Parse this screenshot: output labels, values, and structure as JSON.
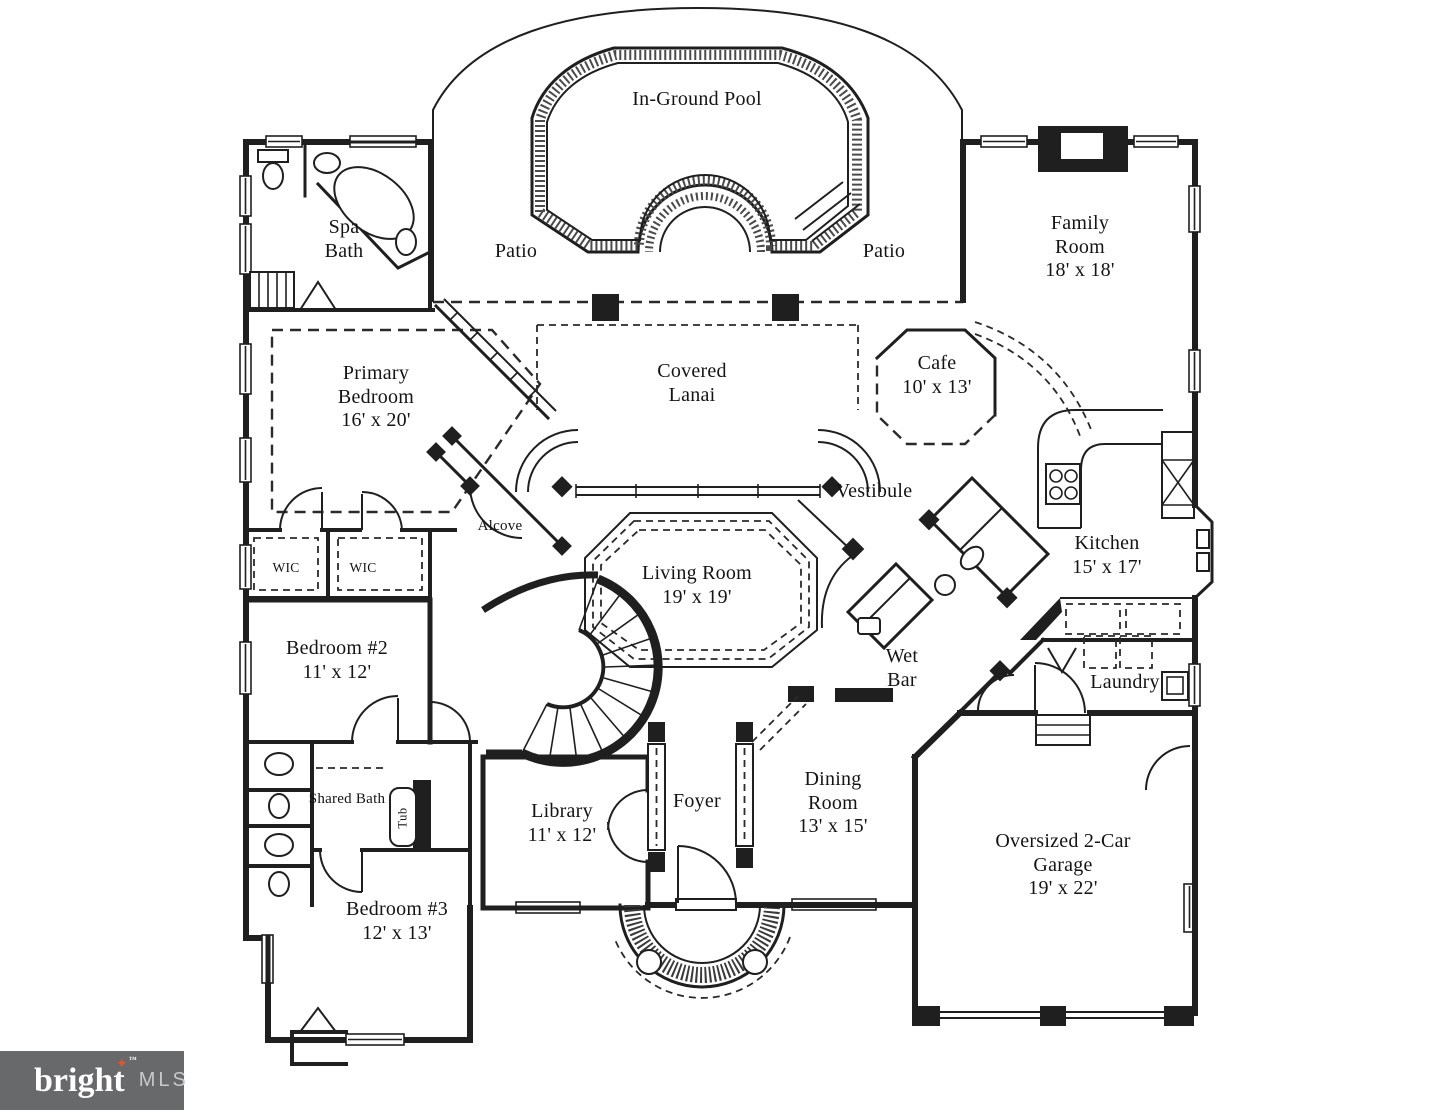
{
  "logo": {
    "brand": "bright",
    "mls": "MLS",
    "tm": "™",
    "star": "✦",
    "bg_color": "#67696B",
    "star_color": "#E2552C",
    "brand_color": "#FFFFFF",
    "mls_color": "#C7C9CA"
  },
  "plan": {
    "line_color": "#1F1F1F",
    "background": "#FFFFFF"
  },
  "rooms": {
    "pool": {
      "name": "In-Ground Pool"
    },
    "patio_left": {
      "name": "Patio"
    },
    "patio_right": {
      "name": "Patio"
    },
    "spa_bath": {
      "name": "Spa Bath"
    },
    "family_room": {
      "name": "Family Room",
      "dims": "18' x 18'"
    },
    "primary_bedroom": {
      "name": "Primary Bedroom",
      "dims": "16' x 20'"
    },
    "covered_lanai": {
      "name": "Covered Lanai"
    },
    "cafe": {
      "name": "Cafe",
      "dims": "10' x 13'"
    },
    "vestibule": {
      "name": "Vestibule"
    },
    "kitchen": {
      "name": "Kitchen",
      "dims": "15' x 17'"
    },
    "alcove": {
      "name": "Alcove"
    },
    "wic_left": {
      "name": "WIC"
    },
    "wic_right": {
      "name": "WIC"
    },
    "living_room": {
      "name": "Living Room",
      "dims": "19' x 19'"
    },
    "bedroom_2": {
      "name": "Bedroom #2",
      "dims": "11' x 12'"
    },
    "wet_bar": {
      "name": "Wet Bar"
    },
    "laundry": {
      "name": "Laundry"
    },
    "shared_bath": {
      "name": "Shared Bath"
    },
    "tub": {
      "name": "Tub"
    },
    "bedroom_3": {
      "name": "Bedroom #3",
      "dims": "12' x 13'"
    },
    "library": {
      "name": "Library",
      "dims": "11' x 12'"
    },
    "foyer": {
      "name": "Foyer"
    },
    "dining_room": {
      "name": "Dining Room",
      "dims": "13' x 15'"
    },
    "garage": {
      "name": "Oversized 2-Car Garage",
      "dims": "19' x 22'"
    }
  }
}
